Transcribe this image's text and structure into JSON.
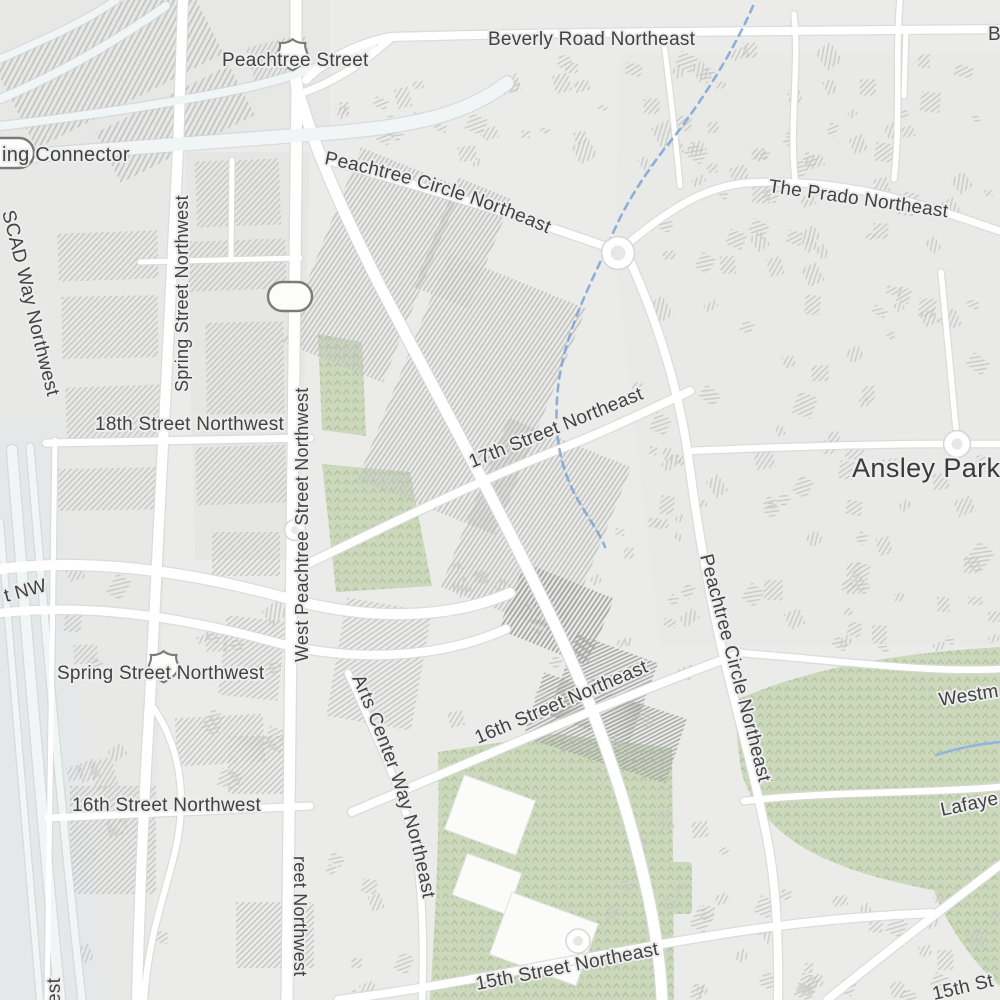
{
  "map": {
    "type": "street-map",
    "locality": {
      "name": "Ansley Park"
    },
    "streets": [
      {
        "id": "peachtree-street",
        "label": "Peachtree Street"
      },
      {
        "id": "beverly-road-northeast",
        "label": "Beverly Road Northeast"
      },
      {
        "id": "connector",
        "label": "ing Connector"
      },
      {
        "id": "peachtree-circle-northeast-top",
        "label": "Peachtree Circle Northeast"
      },
      {
        "id": "the-prado-northeast",
        "label": "The Prado Northeast"
      },
      {
        "id": "scad-way-northwest",
        "label": "SCAD Way Northwest"
      },
      {
        "id": "spring-street-northwest-vertical",
        "label": "Spring Street Northwest"
      },
      {
        "id": "eighteenth-street-northwest",
        "label": "18th Street Northwest"
      },
      {
        "id": "west-peachtree-street-northwest",
        "label": "West Peachtree Street Northwest"
      },
      {
        "id": "seventeenth-street-northeast",
        "label": "17th Street Northeast"
      },
      {
        "id": "street-tail-nw",
        "label": "t NW"
      },
      {
        "id": "spring-street-northwest-horizontal",
        "label": "Spring Street Northwest"
      },
      {
        "id": "sixteenth-street-northeast",
        "label": "16th Street Northeast"
      },
      {
        "id": "arts-center-way-northeast",
        "label": "Arts Center Way Northeast"
      },
      {
        "id": "sixteenth-street-northwest",
        "label": "16th Street Northwest"
      },
      {
        "id": "westminster-partial",
        "label": "Westm"
      },
      {
        "id": "lafayette-partial",
        "label": "Lafaye"
      },
      {
        "id": "peachtree-circle-northeast-right",
        "label": "Peachtree Circle Northeast"
      },
      {
        "id": "fifteenth-street-northeast",
        "label": "15th Street Northeast"
      },
      {
        "id": "fifteenth-street-partial",
        "label": "15th St"
      },
      {
        "id": "beverly-tail-right",
        "label": "B"
      },
      {
        "id": "street-tail-bottom-left",
        "label": "est"
      },
      {
        "id": "west-peachtree-south-tail",
        "label": "reet Northwest"
      }
    ],
    "icons": {
      "us_route_shield": "US highway shield outline",
      "interstate_pill_shield": "rounded pill route shield (cut at left edge)",
      "blank_pill_marker": "blank white rounded pill marker"
    },
    "colors": {
      "background": "#ebecea",
      "road": "#ffffff",
      "park": "#cbd8bc",
      "stream": "#7fa3d4",
      "street_label": "#424242",
      "locality_label": "#3a3a3a",
      "building_hatch": "#c6c7c5"
    }
  }
}
